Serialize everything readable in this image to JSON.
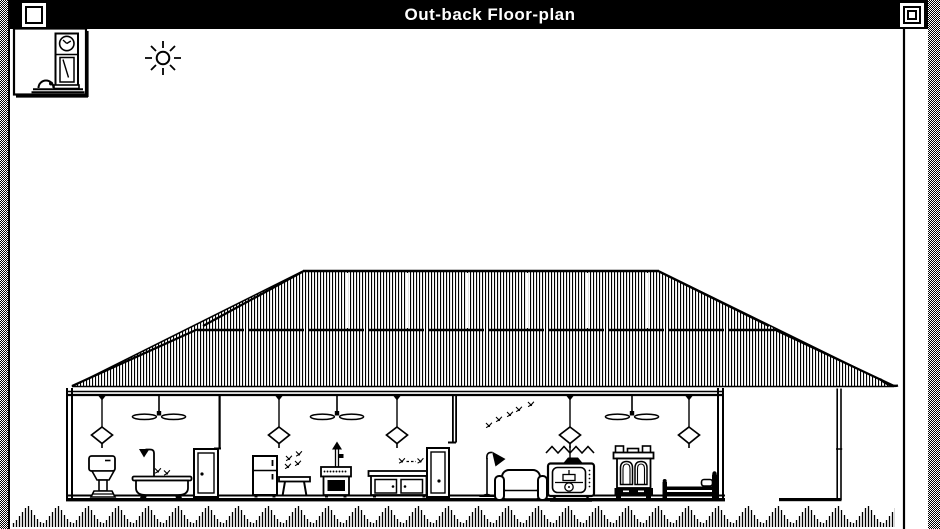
{
  "window": {
    "title": "Out-back Floor-plan",
    "controls": {
      "close": "close-box",
      "zoom": "zoom-box"
    }
  },
  "colors": {
    "ink": "#000000",
    "paper": "#ffffff",
    "titlebar": "#000000",
    "desktop": "50%-dither"
  },
  "scene": {
    "type": "1-bit line drawing, cross-section of an outback homestead",
    "decorations": [
      "grandfather-clock-picture",
      "sun"
    ],
    "roof": {
      "style": "corrugated-iron hip roof",
      "courses": 2,
      "seam": "horizontal sheet seam"
    },
    "rooms": [
      {
        "name": "bathroom",
        "items": [
          "pendant-lamp",
          "ceiling-fan",
          "toilet",
          "bathtub",
          "shower",
          "flies",
          "door"
        ]
      },
      {
        "name": "kitchen",
        "items": [
          "fridge",
          "flies",
          "side-table",
          "pendant-lamp",
          "ceiling-fan",
          "wood-stove",
          "stovepipe",
          "sink-cabinet",
          "flies",
          "pendant-lamp",
          "door"
        ]
      },
      {
        "name": "living-room",
        "items": [
          "flies",
          "floor-lamp",
          "couch",
          "pendant-lamp",
          "television",
          "zigzag-aerial",
          "ceiling-fan"
        ]
      },
      {
        "name": "bedroom",
        "items": [
          "wardrobe",
          "pendant-lamp",
          "bed"
        ]
      }
    ],
    "veranda": [
      "roof-overhang",
      "veranda-post",
      "step"
    ],
    "ground": "grass-tufts"
  }
}
